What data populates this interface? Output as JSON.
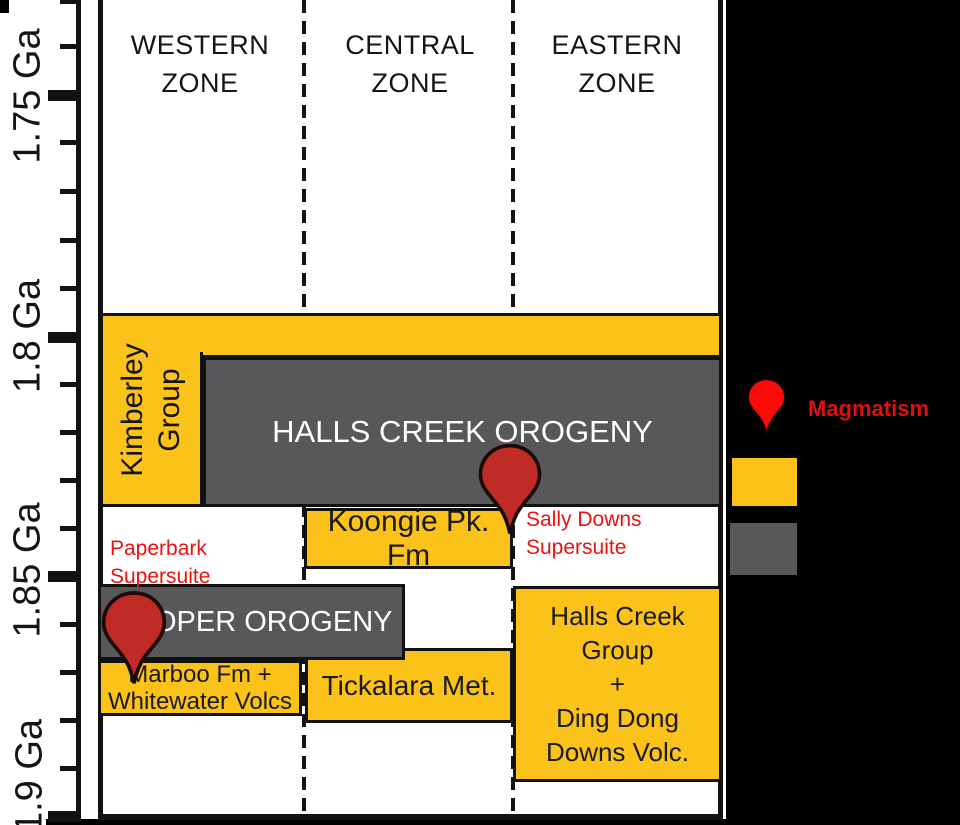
{
  "axis": {
    "unit": "Ga",
    "ticks": [
      "1.75 Ga",
      "1.8 Ga",
      "1.85 Ga",
      "1.9 Ga"
    ],
    "minor_tick_interval_ga": 0.01
  },
  "zones": {
    "western": "WESTERN\nZONE",
    "central": "CENTRAL\nZONE",
    "eastern": "EASTERN\nZONE"
  },
  "events": {
    "kimberley_group": {
      "label": "Kimberley\nGroup",
      "kind": "stratigraphic-unit",
      "zone": "western",
      "approx_age_ga": [
        1.795,
        1.835
      ]
    },
    "kimberley_bar": {
      "label": "",
      "kind": "stratigraphic-unit",
      "zone": "western+central+eastern",
      "approx_age_ga": [
        1.795,
        1.805
      ]
    },
    "halls_creek_orogeny": {
      "label": "HALLS CREEK OROGENY",
      "kind": "orogeny",
      "zone": "western+central+eastern",
      "approx_age_ga": [
        1.805,
        1.835
      ]
    },
    "koongie_pk_fm": {
      "label": "Koongie Pk. Fm",
      "kind": "stratigraphic-unit",
      "zone": "central",
      "approx_age_ga": [
        1.835,
        1.848
      ]
    },
    "paperbark_supersuite": {
      "label": "Paperbark\nSupersuite",
      "kind": "annotation",
      "zone": "western",
      "approx_age_ga": [
        1.84,
        1.85
      ]
    },
    "sally_downs_supersuite": {
      "label": "Sally Downs\nSupersuite",
      "kind": "annotation",
      "zone": "eastern",
      "approx_age_ga": [
        1.835,
        1.845
      ]
    },
    "hooper_orogeny": {
      "label": "HOOPER OROGENY",
      "kind": "orogeny",
      "zone": "western+central",
      "approx_age_ga": [
        1.851,
        1.867
      ]
    },
    "marboo_fm": {
      "label": "Marboo Fm +\nWhitewater Volcs",
      "kind": "stratigraphic-unit",
      "zone": "western",
      "approx_age_ga": [
        1.867,
        1.878
      ]
    },
    "tickalara_met": {
      "label": "Tickalara Met.",
      "kind": "stratigraphic-unit",
      "zone": "central",
      "approx_age_ga": [
        1.864,
        1.88
      ]
    },
    "halls_creek_group": {
      "label": "Halls Creek\nGroup\n+\nDing Dong\nDowns Volc.",
      "kind": "stratigraphic-unit",
      "zone": "eastern",
      "approx_age_ga": [
        1.851,
        1.892
      ]
    }
  },
  "markers": {
    "magmatism_pins": [
      {
        "location": "central-eastern boundary",
        "approx_age_ga": 1.842
      },
      {
        "location": "western",
        "approx_age_ga": 1.873
      }
    ]
  },
  "legend": {
    "magmatism_label": "Magmatism",
    "swatches": [
      {
        "name": "stratigraphic-unit",
        "color": "#FBC21A"
      },
      {
        "name": "orogeny",
        "color": "#58585A"
      }
    ]
  },
  "colors": {
    "unit_yellow": "#FBC21A",
    "orogeny_gray": "#58585A",
    "pin_red": "#C12B26",
    "legend_pin_red": "#FA0B07",
    "annotation_red": "#ED1011",
    "frame_black": "#121212",
    "panel_black": "#000000",
    "background_white": "#FFFFFF"
  }
}
